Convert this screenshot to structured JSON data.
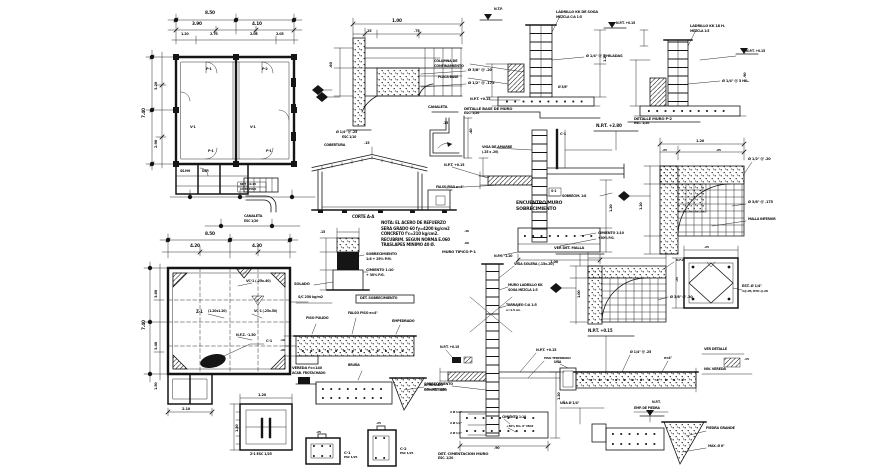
{
  "palette": {
    "background": "#ffffff",
    "ink": "#151515"
  },
  "labels": [
    {
      "x": 205,
      "y": 12,
      "t": "8.50"
    },
    {
      "x": 192,
      "y": 23,
      "t": "3.90"
    },
    {
      "x": 252,
      "y": 23,
      "t": "4.10"
    },
    {
      "x": 181,
      "y": 33,
      "t": "1.20",
      "s": 3.4
    },
    {
      "x": 210,
      "y": 33,
      "t": "2.70",
      "s": 3.4
    },
    {
      "x": 250,
      "y": 33,
      "t": "2.05",
      "s": 3.4
    },
    {
      "x": 276,
      "y": 33,
      "t": "2.05",
      "s": 3.4
    },
    {
      "x": 143,
      "y": 118,
      "t": "7.40",
      "r": -90
    },
    {
      "x": 155,
      "y": 90,
      "t": "3.20",
      "s": 3.6,
      "r": -90
    },
    {
      "x": 155,
      "y": 148,
      "t": "2.90",
      "s": 3.6,
      "r": -90
    },
    {
      "x": 206,
      "y": 68,
      "t": "P-1",
      "s": 3.4
    },
    {
      "x": 262,
      "y": 68,
      "t": "P-2",
      "s": 3.4
    },
    {
      "x": 190,
      "y": 126,
      "t": "V-1",
      "s": 3.4
    },
    {
      "x": 250,
      "y": 126,
      "t": "V-1",
      "s": 3.4
    },
    {
      "x": 208,
      "y": 150,
      "t": "P-1",
      "s": 3.4
    },
    {
      "x": 266,
      "y": 150,
      "t": "P-1",
      "s": 3.4
    },
    {
      "x": 180,
      "y": 170,
      "t": "SS.HH",
      "s": 3.2
    },
    {
      "x": 202,
      "y": 170,
      "t": "DEP.",
      "s": 3.2
    },
    {
      "x": 240,
      "y": 183,
      "t": "NPT +0.15",
      "s": 3.0
    },
    {
      "x": 240,
      "y": 188,
      "t": "COTA PISO",
      "s": 3.0
    },
    {
      "x": 244,
      "y": 215,
      "t": "CANALETA",
      "s": 3.4
    },
    {
      "x": 244,
      "y": 220,
      "t": "ESC 1/20",
      "s": 3.2
    },
    {
      "x": 205,
      "y": 233,
      "t": "8.50"
    },
    {
      "x": 190,
      "y": 245,
      "t": "4.20"
    },
    {
      "x": 252,
      "y": 245,
      "t": "4.30"
    },
    {
      "x": 143,
      "y": 330,
      "t": "7.40",
      "r": -90
    },
    {
      "x": 155,
      "y": 298,
      "t": "3.60",
      "s": 3.6,
      "r": -90
    },
    {
      "x": 155,
      "y": 350,
      "t": "3.40",
      "s": 3.6,
      "r": -90
    },
    {
      "x": 246,
      "y": 280,
      "t": "VC-1 (.25x.40)",
      "s": 3.4
    },
    {
      "x": 196,
      "y": 310,
      "t": "Z-1",
      "s": 4,
      "w": 700
    },
    {
      "x": 208,
      "y": 310,
      "t": "(1.20x1.20)",
      "s": 3.2
    },
    {
      "x": 254,
      "y": 310,
      "t": "VC-1 (.25x.50)",
      "s": 3.2
    },
    {
      "x": 236,
      "y": 334,
      "t": "N.F.Z. -1.50",
      "s": 3.4
    },
    {
      "x": 266,
      "y": 340,
      "t": "C-1",
      "s": 3.6
    },
    {
      "x": 298,
      "y": 296,
      "t": "S/C 250 kg/m2",
      "s": 3.4
    },
    {
      "x": 182,
      "y": 408,
      "t": "2.10",
      "s": 3.6
    },
    {
      "x": 155,
      "y": 390,
      "t": "1.50",
      "s": 3.4,
      "r": -90
    },
    {
      "x": 392,
      "y": 20,
      "t": "1.00"
    },
    {
      "x": 366,
      "y": 30,
      "t": ".25",
      "s": 3.4
    },
    {
      "x": 414,
      "y": 30,
      "t": ".75",
      "s": 3.4
    },
    {
      "x": 330,
      "y": 68,
      "t": ".60",
      "s": 3.6,
      "r": -90
    },
    {
      "x": 468,
      "y": 68,
      "t": "Ø 3/8\" @ .20",
      "s": 3.8
    },
    {
      "x": 468,
      "y": 81,
      "t": "Ø 1/2\" @ .175",
      "s": 3.8
    },
    {
      "x": 336,
      "y": 131,
      "t": "Ø 1/4\" @ .25",
      "s": 3.4
    },
    {
      "x": 342,
      "y": 136,
      "t": "ESC 1/10",
      "s": 3.2
    },
    {
      "x": 364,
      "y": 142,
      "t": ".15",
      "s": 3.4
    },
    {
      "x": 324,
      "y": 144,
      "t": "COBERTURA",
      "s": 3.4
    },
    {
      "x": 352,
      "y": 215,
      "t": "CORTE A-A",
      "s": 4,
      "w": 700
    },
    {
      "x": 428,
      "y": 106,
      "t": "CANALETA",
      "s": 3.6
    },
    {
      "x": 470,
      "y": 134,
      "t": ".40",
      "s": 3.4,
      "r": -90
    },
    {
      "x": 443,
      "y": 122,
      "t": ".15",
      "s": 3.2
    },
    {
      "x": 366,
      "y": 253,
      "t": "SOBRECIMIENTO",
      "s": 3.6
    },
    {
      "x": 366,
      "y": 258,
      "t": "1:8 + 25% P.M.",
      "s": 3.4
    },
    {
      "x": 366,
      "y": 269,
      "t": "CIMIENTO 1:10",
      "s": 3.6
    },
    {
      "x": 366,
      "y": 274,
      "t": "+ 30% P.G.",
      "s": 3.4
    },
    {
      "x": 294,
      "y": 283,
      "t": "SOLADO",
      "s": 3.6
    },
    {
      "x": 320,
      "y": 231,
      "t": ".15",
      "s": 3.2
    },
    {
      "x": 381,
      "y": 221,
      "t": "NOTA: EL ACERO DE REFUERZO",
      "s": 4,
      "w": 700
    },
    {
      "x": 381,
      "y": 226.5,
      "t": "SERA GRADO 60 fy=4200 kg/cm2",
      "s": 4,
      "w": 700
    },
    {
      "x": 381,
      "y": 232,
      "t": "CONCRETO f'c=210 kg/cm2.",
      "s": 4,
      "w": 700
    },
    {
      "x": 381,
      "y": 237.5,
      "t": "RECUBRIM. SEGUN NORMA E.060",
      "s": 4,
      "w": 700
    },
    {
      "x": 381,
      "y": 243,
      "t": "TRASLAPES MINIMO 40 Ø.",
      "s": 4,
      "w": 700
    },
    {
      "x": 360,
      "y": 297,
      "t": "DET. SOBRECIMIENTO",
      "s": 3.4,
      "w": 700
    },
    {
      "x": 306,
      "y": 317,
      "t": "PISO PULIDO",
      "s": 3.4
    },
    {
      "x": 348,
      "y": 312,
      "t": "FALSO PISO e=4\"",
      "s": 3.4
    },
    {
      "x": 392,
      "y": 320,
      "t": "EMPEDRADO",
      "s": 3.4
    },
    {
      "x": 280,
      "y": 339,
      "t": ".10",
      "s": 3.0
    },
    {
      "x": 280,
      "y": 349,
      "t": ".20",
      "s": 3.0
    },
    {
      "x": 292,
      "y": 367,
      "t": "VEREDA f'c=140",
      "s": 3.6,
      "w": 700
    },
    {
      "x": 292,
      "y": 372,
      "t": "ACAB. FROTACHADO",
      "s": 3.2
    },
    {
      "x": 424,
      "y": 384,
      "t": "AFIRMADO",
      "s": 3.4
    },
    {
      "x": 424,
      "y": 389,
      "t": "COMPACTADO",
      "s": 3.2
    },
    {
      "x": 348,
      "y": 364,
      "t": "BRUÑA",
      "s": 3.2
    },
    {
      "x": 258,
      "y": 394,
      "t": "1.20",
      "s": 3.6
    },
    {
      "x": 236,
      "y": 432,
      "t": "1.20",
      "s": 3.4,
      "r": -90
    },
    {
      "x": 250,
      "y": 453,
      "t": "Z-1  ESC 1/25",
      "s": 3.4
    },
    {
      "x": 344,
      "y": 451,
      "t": "C-1",
      "s": 3.8,
      "w": 700
    },
    {
      "x": 344,
      "y": 456,
      "t": "ESC 1/25",
      "s": 3.0
    },
    {
      "x": 316,
      "y": 431,
      "t": ".25",
      "s": 3.0
    },
    {
      "x": 400,
      "y": 447,
      "t": "C-2",
      "s": 3.8,
      "w": 700
    },
    {
      "x": 400,
      "y": 452,
      "t": "ESC 1/25",
      "s": 3.0
    },
    {
      "x": 376,
      "y": 422,
      "t": ".25",
      "s": 3.0
    },
    {
      "x": 556,
      "y": 11,
      "t": "LADRILLO KK DE SOGA",
      "s": 3.6
    },
    {
      "x": 556,
      "y": 16,
      "t": "MEZCLA C:A 1:5",
      "s": 3.2
    },
    {
      "x": 586,
      "y": 55,
      "t": "Ø 1/4\" @ 3 HILADAS",
      "s": 3.6
    },
    {
      "x": 434,
      "y": 60,
      "t": "COLUMNA DE",
      "s": 3.4
    },
    {
      "x": 434,
      "y": 65,
      "t": "CONFINAMIENTO",
      "s": 3.4
    },
    {
      "x": 438,
      "y": 76,
      "t": "PLACA BASE",
      "s": 3.2
    },
    {
      "x": 470,
      "y": 98,
      "t": "N.P.T. +0.15",
      "s": 3.4
    },
    {
      "x": 464,
      "y": 107,
      "t": "DETALLE BASE DE MURO",
      "s": 3.8,
      "w": 700
    },
    {
      "x": 464,
      "y": 112,
      "t": "ESC. 1/20",
      "s": 3.2
    },
    {
      "x": 494,
      "y": 8,
      "t": "N.T.P.",
      "s": 3.2
    },
    {
      "x": 616,
      "y": 22,
      "t": "N.P.T. +0.15",
      "s": 3.2
    },
    {
      "x": 604,
      "y": 62,
      "t": "1.20",
      "s": 3.4,
      "r": -90
    },
    {
      "x": 558,
      "y": 86,
      "t": "Ø 3/8\"",
      "s": 3.2
    },
    {
      "x": 690,
      "y": 25,
      "t": "LADRILLO KK 18 H.",
      "s": 3.6
    },
    {
      "x": 690,
      "y": 30,
      "t": "MEZCLA 1:5",
      "s": 3.2
    },
    {
      "x": 746,
      "y": 50,
      "t": "N.P.T. +0.15",
      "s": 3.2
    },
    {
      "x": 722,
      "y": 80,
      "t": "Ø 1/4\" @ 3 HIL.",
      "s": 3.6
    },
    {
      "x": 634,
      "y": 117,
      "t": "DETALLE MURO P-2",
      "s": 3.8,
      "w": 700
    },
    {
      "x": 634,
      "y": 122,
      "t": "ESC. 1/20",
      "s": 3.2
    },
    {
      "x": 744,
      "y": 78,
      "t": ".90",
      "s": 3.4,
      "r": -90
    },
    {
      "x": 596,
      "y": 124,
      "t": "N.P.T. +2.80",
      "s": 4.2,
      "w": 800
    },
    {
      "x": 482,
      "y": 146,
      "t": "VIGA DE AMARRE",
      "s": 3.4
    },
    {
      "x": 482,
      "y": 151,
      "t": "(.25 x .20)",
      "s": 3.2
    },
    {
      "x": 444,
      "y": 164,
      "t": "N.P.T. +0.15",
      "s": 3.4
    },
    {
      "x": 436,
      "y": 186,
      "t": "FALSO PISO e=4\"",
      "s": 3.2
    },
    {
      "x": 551,
      "y": 190,
      "t": "S-1",
      "s": 3.2
    },
    {
      "x": 560,
      "y": 133,
      "t": "C-1",
      "s": 3.6
    },
    {
      "x": 516,
      "y": 202,
      "t": "ENCUENTRO MURO",
      "s": 4.6,
      "w": 800
    },
    {
      "x": 516,
      "y": 208,
      "t": "SOBRECIMIENTO",
      "s": 4.6,
      "w": 800
    },
    {
      "x": 562,
      "y": 195,
      "t": "SOBRECIM. 1:8",
      "s": 3.2
    },
    {
      "x": 598,
      "y": 232,
      "t": "CIMIENTO 1:10",
      "s": 3.4
    },
    {
      "x": 598,
      "y": 237,
      "t": "+30% P.G.",
      "s": 3.2
    },
    {
      "x": 550,
      "y": 261,
      "t": "1.00",
      "s": 3.6
    },
    {
      "x": 610,
      "y": 212,
      "t": "1.20",
      "s": 3.4,
      "r": -90
    },
    {
      "x": 464,
      "y": 230,
      "t": ".40",
      "s": 3.0
    },
    {
      "x": 464,
      "y": 242,
      "t": ".60",
      "s": 3.0
    },
    {
      "x": 494,
      "y": 255,
      "t": "N.F.C. -1.20",
      "s": 3.2
    },
    {
      "x": 696,
      "y": 140,
      "t": "1.20",
      "s": 3.6
    },
    {
      "x": 662,
      "y": 149,
      "t": ".25",
      "s": 3.0
    },
    {
      "x": 716,
      "y": 149,
      "t": ".95",
      "s": 3.0
    },
    {
      "x": 748,
      "y": 158,
      "t": "Ø 1/2\" @ .20",
      "s": 3.6
    },
    {
      "x": 748,
      "y": 201,
      "t": "Ø 3/8\" @ .175",
      "s": 3.6
    },
    {
      "x": 748,
      "y": 218,
      "t": "MALLA INFERIOR",
      "s": 3.2
    },
    {
      "x": 640,
      "y": 210,
      "t": "1.20",
      "s": 3.4,
      "r": -90
    },
    {
      "x": 554,
      "y": 247,
      "t": "VER DET. MALLA",
      "s": 3.6,
      "w": 700
    },
    {
      "x": 670,
      "y": 296,
      "t": "Ø 3/8\" @ .20",
      "s": 3.6
    },
    {
      "x": 676,
      "y": 259,
      "t": "N.F.Z.",
      "s": 3.0
    },
    {
      "x": 578,
      "y": 298,
      "t": "1.00",
      "s": 3.4,
      "r": -90
    },
    {
      "x": 742,
      "y": 285,
      "t": "EST. Ø 1/4\"",
      "s": 3.6
    },
    {
      "x": 742,
      "y": 290,
      "t": "1@.05, RTO @.20",
      "s": 3.0
    },
    {
      "x": 704,
      "y": 246,
      "t": ".25",
      "s": 3.0
    },
    {
      "x": 676,
      "y": 282,
      "t": ".25",
      "s": 3.0,
      "r": -90
    },
    {
      "x": 442,
      "y": 250,
      "t": "MURO TIPICO P-1",
      "s": 3.8,
      "w": 700
    },
    {
      "x": 514,
      "y": 263,
      "t": "VIGA SOLERA (.15x.20)",
      "s": 3.4
    },
    {
      "x": 508,
      "y": 284,
      "t": "MURO LADRILLO KK",
      "s": 3.4
    },
    {
      "x": 508,
      "y": 289,
      "t": "SOGA MEZCLA 1:5",
      "s": 3.2
    },
    {
      "x": 506,
      "y": 304,
      "t": "TARRAJEO C:A 1:5",
      "s": 3.4
    },
    {
      "x": 506,
      "y": 309,
      "t": "e=1.5 cm",
      "s": 3.0
    },
    {
      "x": 536,
      "y": 349,
      "t": "N.P.T. +0.15",
      "s": 3.4
    },
    {
      "x": 544,
      "y": 357,
      "t": "PISO TERMINADO",
      "s": 3.0
    },
    {
      "x": 440,
      "y": 346,
      "t": "N.P.T. +0.15",
      "s": 3.2
    },
    {
      "x": 424,
      "y": 383,
      "t": "SOBRECIMIENTO",
      "s": 3.4,
      "w": 700
    },
    {
      "x": 424,
      "y": 388,
      "t": "1:8 + 25% P.M.",
      "s": 3.0
    },
    {
      "x": 450,
      "y": 411,
      "t": "2 Ø 1/2\"",
      "s": 3.0
    },
    {
      "x": 450,
      "y": 422,
      "t": "2 Ø 1/2\"",
      "s": 3.0
    },
    {
      "x": 450,
      "y": 432,
      "t": "2 Ø 1/2\"",
      "s": 3.0
    },
    {
      "x": 502,
      "y": 416,
      "t": "CIMIENTO 1:10",
      "s": 3.2
    },
    {
      "x": 506,
      "y": 425,
      "t": "+30% P.G. 6\" MAX",
      "s": 3.0
    },
    {
      "x": 494,
      "y": 447,
      "t": ".90",
      "s": 3.4
    },
    {
      "x": 438,
      "y": 452,
      "t": "DET. CIMENTACION MURO",
      "s": 3.8,
      "w": 700
    },
    {
      "x": 438,
      "y": 457,
      "t": "ESC. 1/20",
      "s": 3.2
    },
    {
      "x": 558,
      "y": 400,
      "t": "1.20",
      "s": 3.4,
      "r": -90
    },
    {
      "x": 588,
      "y": 329,
      "t": "N.P.T. +0.15",
      "s": 4,
      "w": 700
    },
    {
      "x": 630,
      "y": 351,
      "t": "Ø 1/4\" @ .25",
      "s": 3.4
    },
    {
      "x": 664,
      "y": 357,
      "t": "e=4\"",
      "s": 3.2
    },
    {
      "x": 554,
      "y": 361,
      "t": "UÑA",
      "s": 3.2
    },
    {
      "x": 704,
      "y": 348,
      "t": "VER DETALLE",
      "s": 3.4
    },
    {
      "x": 704,
      "y": 368,
      "t": "NIV. VEREDA",
      "s": 3.4
    },
    {
      "x": 744,
      "y": 358,
      "t": ".15",
      "s": 3.0
    },
    {
      "x": 560,
      "y": 402,
      "t": "UÑA Ø 1/4\"",
      "s": 3.4
    },
    {
      "x": 652,
      "y": 401,
      "t": "N.P.T.",
      "s": 3.2
    },
    {
      "x": 634,
      "y": 407,
      "t": "EMP. DE PIEDRA",
      "s": 3.2
    },
    {
      "x": 706,
      "y": 427,
      "t": "PIEDRA GRANDE",
      "s": 3.4
    },
    {
      "x": 708,
      "y": 445,
      "t": "MAX. Ø 8\"",
      "s": 3.2
    }
  ]
}
